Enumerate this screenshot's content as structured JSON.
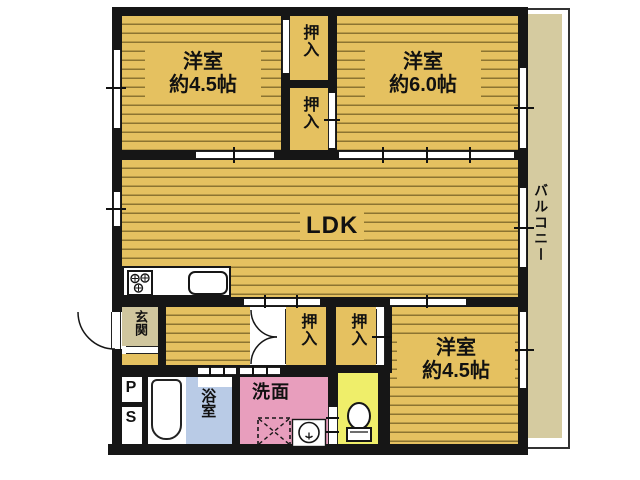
{
  "plan_title": "2LDK apartment floor plan",
  "rooms": {
    "bedroom_nw": {
      "name": "洋室",
      "size": "約4.5帖"
    },
    "bedroom_ne": {
      "name": "洋室",
      "size": "約6.0帖"
    },
    "bedroom_se": {
      "name": "洋室",
      "size": "約4.5帖"
    },
    "ldk": {
      "name": "LDK"
    },
    "entrance": {
      "name": "玄関"
    },
    "bathroom": {
      "name": "浴室"
    },
    "washroom": {
      "name": "洗面"
    },
    "balcony": {
      "name": "バルコニー"
    },
    "pipe_space": {
      "line1": "P",
      "line2": "S"
    }
  },
  "closets": [
    {
      "name": "押入"
    },
    {
      "name": "押入"
    },
    {
      "name": "押入"
    },
    {
      "name": "押入"
    }
  ],
  "icons": [
    "stove-icon",
    "kitchen-sink-icon",
    "bathtub-icon",
    "toilet-icon",
    "washing-machine-icon",
    "lavatory-icon",
    "entrance-door-swing-icon",
    "closet-double-door-icon"
  ],
  "colors": {
    "floor": "#e5c160",
    "floor_stripe": "#8c7431",
    "wall": "#161616",
    "balcony": "#d5cba0",
    "entrance": "#d0c69e",
    "bathroom": "#b9cbe6",
    "washroom": "#e89ebd",
    "toilet": "#efee6a"
  }
}
